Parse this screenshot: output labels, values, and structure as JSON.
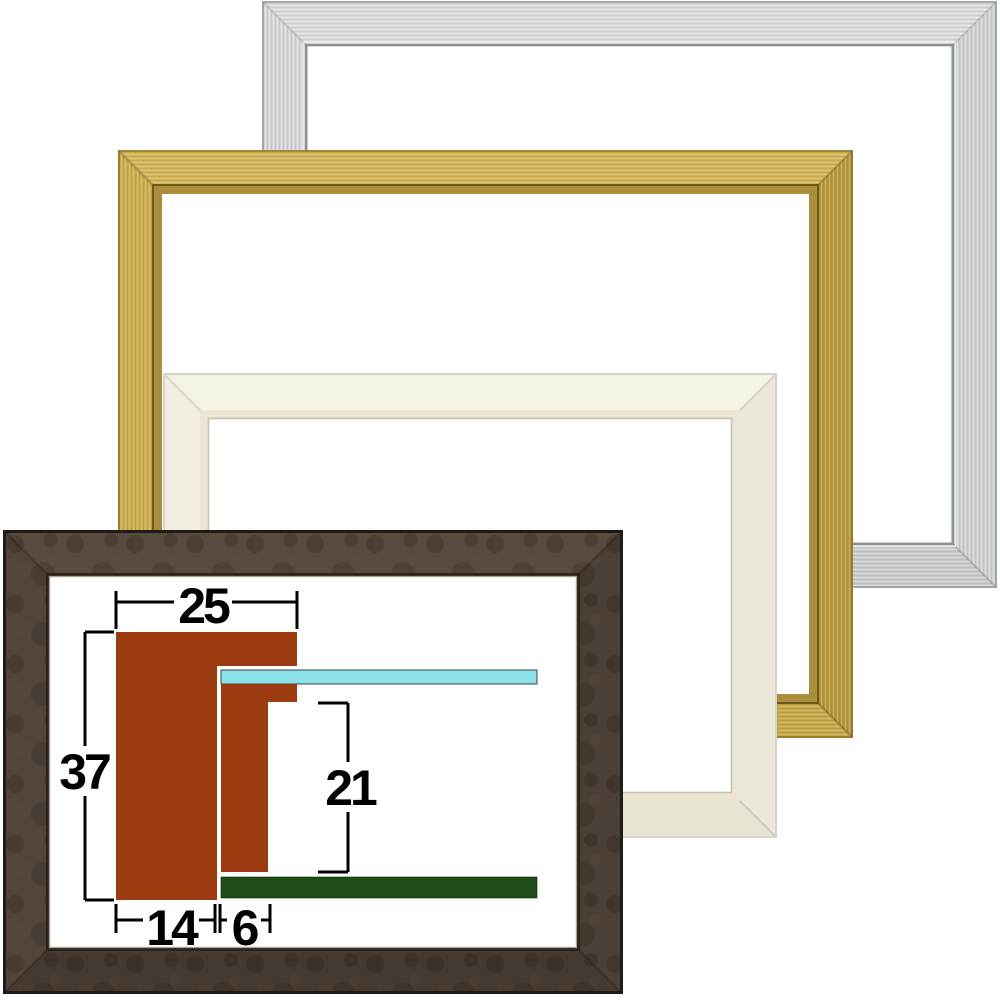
{
  "image": {
    "kind": "picture-frame product photo composite with profile cross-section diagram",
    "background": "#ffffff"
  },
  "frames": [
    {
      "name": "silver",
      "finish": "brushed silver",
      "base": "#d2d4d5",
      "top": "#dbdcdd",
      "left": "#d4d6d7",
      "right": "#ced1d2",
      "bottom": "#c7cacc"
    },
    {
      "name": "gold",
      "finish": "brushed gold",
      "base": "#c9a94c",
      "top": "#d4b75d",
      "left": "#cbab4f",
      "right": "#b8983f",
      "bottom": "#c7a74c"
    },
    {
      "name": "ivory",
      "finish": "matte ivory",
      "base": "#f2eee1",
      "top": "#f6f3e7",
      "left": "#f2eee1",
      "right": "#ece8d9",
      "bottom": "#e8e4d4"
    },
    {
      "name": "dark-brown",
      "finish": "mottled dark walnut",
      "base": "#50443a",
      "top": "#584a3f",
      "left": "#51453b",
      "right": "#4b4037",
      "bottom": "#453a31"
    }
  ],
  "diagram": {
    "description": "frame molding cross-section with dimension annotations",
    "colors": {
      "profile": "#9c3a10",
      "glass": "#8ee1ea",
      "backing": "#1e4b17",
      "dimension_lines": "#000000"
    },
    "dimensions": [
      {
        "name": "total_width",
        "value": "25"
      },
      {
        "name": "total_height",
        "value": "37"
      },
      {
        "name": "rabbet_depth",
        "value": "21"
      },
      {
        "name": "base_width",
        "value": "14"
      },
      {
        "name": "lip_width",
        "value": "6"
      }
    ]
  }
}
